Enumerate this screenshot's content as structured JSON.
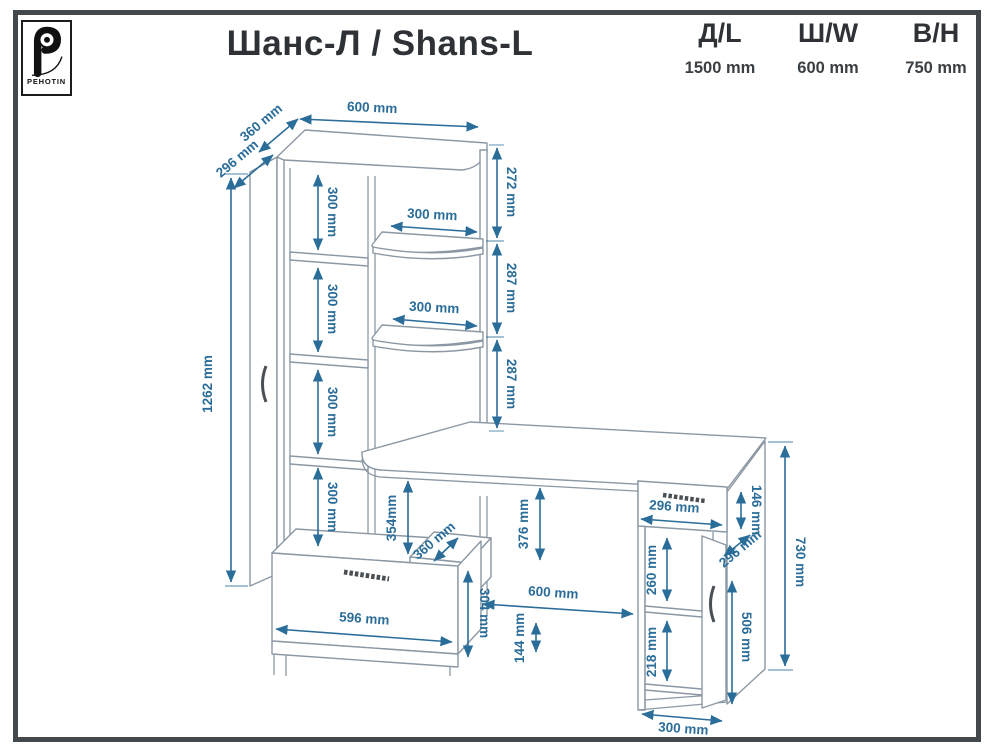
{
  "header": {
    "brand": "PEHOTIN",
    "title": "Шанс-Л / Shans-L",
    "specs": [
      {
        "label": "Д/L",
        "value": "1500 mm"
      },
      {
        "label": "Ш/W",
        "value": "600 mm"
      },
      {
        "label": "В/Н",
        "value": "750 mm"
      }
    ]
  },
  "icons": {
    "logo": "pehotin-gear-p-logo"
  },
  "accent_color": "#2b6d99",
  "line_color": "#8b98a4",
  "dims": {
    "top_width": "600 mm",
    "top_depth": "360 mm",
    "door_depth": "296 mm",
    "upper_right_gap": "272 mm",
    "shelf_gap_a": "287 mm",
    "shelf_gap_b": "287 mm",
    "tower_height": "1262 mm",
    "tower_gap_1": "300 mm",
    "tower_gap_2": "300 mm",
    "tower_gap_3": "300 mm",
    "tower_gap_4": "300 mm",
    "small_shelf_width_a": "300 mm",
    "small_shelf_width_b": "300 mm",
    "desk_clearance_left": "354mm",
    "desk_clearance_mid": "376 mm",
    "pencil_drawer_depth": "360 mm",
    "drawer_width": "596 mm",
    "drawer_height": "304 mm",
    "kneehole_width": "600 mm",
    "plinth_height": "144 mm",
    "cab_drawer_width": "296 mm",
    "cab_drawer_height": "146 mm",
    "cab_door_depth": "296 mm",
    "cab_gap_upper": "260 mm",
    "cab_gap_lower": "218 mm",
    "cab_door_height": "506 mm",
    "cab_depth": "300 mm",
    "desk_height": "730 mm"
  }
}
